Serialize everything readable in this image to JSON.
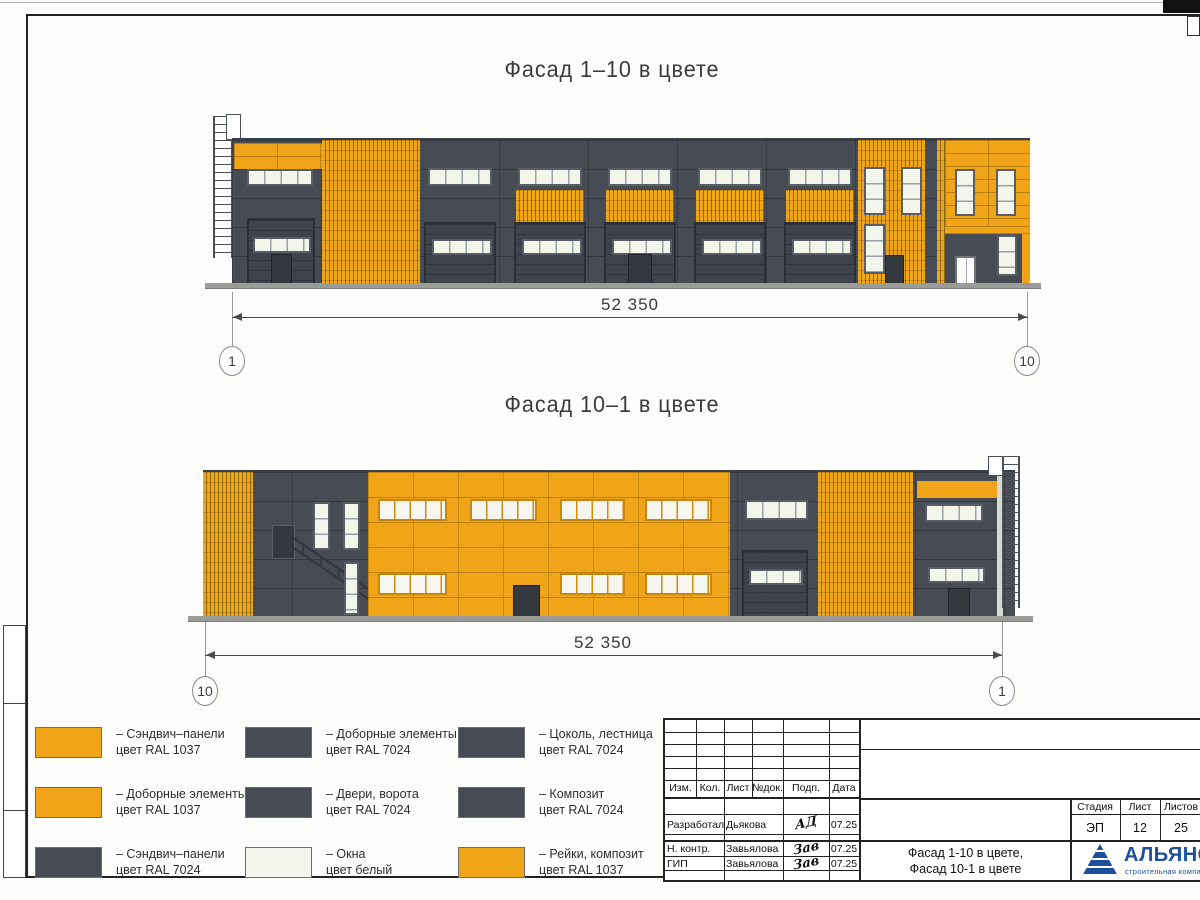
{
  "facades": {
    "f1": {
      "title": "Фасад 1–10 в цвете",
      "dimension": "52 350",
      "axis_left": "1",
      "axis_right": "10"
    },
    "f2": {
      "title": "Фасад 10–1 в цвете",
      "dimension": "52 350",
      "axis_left": "10",
      "axis_right": "1"
    }
  },
  "legend": {
    "items": [
      {
        "color": "#F0A417",
        "line1": "– Сэндвич–панели",
        "line2": "цвет RAL 1037"
      },
      {
        "color": "#F0A417",
        "line1": "– Доборные элементы",
        "line2": "цвет RAL 1037"
      },
      {
        "color": "#474B54",
        "line1": "– Сэндвич–панели",
        "line2": "цвет RAL 7024"
      },
      {
        "color": "#474B54",
        "line1": "– Доборные элементы",
        "line2": "цвет RAL 7024"
      },
      {
        "color": "#474B54",
        "line1": "– Двери, ворота",
        "line2": "цвет RAL 7024"
      },
      {
        "color": "#F4F5EC",
        "line1": "– Окна",
        "line2": "цвет белый"
      },
      {
        "color": "#474B54",
        "line1": "– Цоколь, лестница",
        "line2": "цвет RAL 7024"
      },
      {
        "color": "#474B54",
        "line1": "– Композит",
        "line2": "цвет RAL 7024"
      },
      {
        "color": "#F0A417",
        "line1": "– Рейки, композит",
        "line2": "цвет RAL 1037"
      }
    ]
  },
  "title_block": {
    "rev_headers": [
      "Изм.",
      "Кол.",
      "Лист",
      "№док.",
      "Подп.",
      "Дата"
    ],
    "rows": [
      {
        "role": "Разработал",
        "name": "Дьякова",
        "sig": "АД",
        "date": "07.25"
      },
      {
        "role": "Н. контр.",
        "name": "Завьялова",
        "sig": "Зав",
        "date": "07.25"
      },
      {
        "role": "ГИП",
        "name": "Завьялова",
        "sig": "Зав",
        "date": "07.25"
      }
    ],
    "stage_headers": [
      "Стадия",
      "Лист",
      "Листов"
    ],
    "stage_values": [
      "ЭП",
      "12",
      "25"
    ],
    "doc_title_line1": "Фасад 1-10 в цвете,",
    "doc_title_line2": "Фасад 10-1 в цвете",
    "logo": {
      "name": "АЛЬЯНС",
      "subtitle": "строительная компания"
    }
  },
  "colors": {
    "ral1037_orange": "#F0A417",
    "ral7024_grey": "#474B54",
    "window_white": "#F4F5EC",
    "logo_blue": "#1E4F9C"
  }
}
